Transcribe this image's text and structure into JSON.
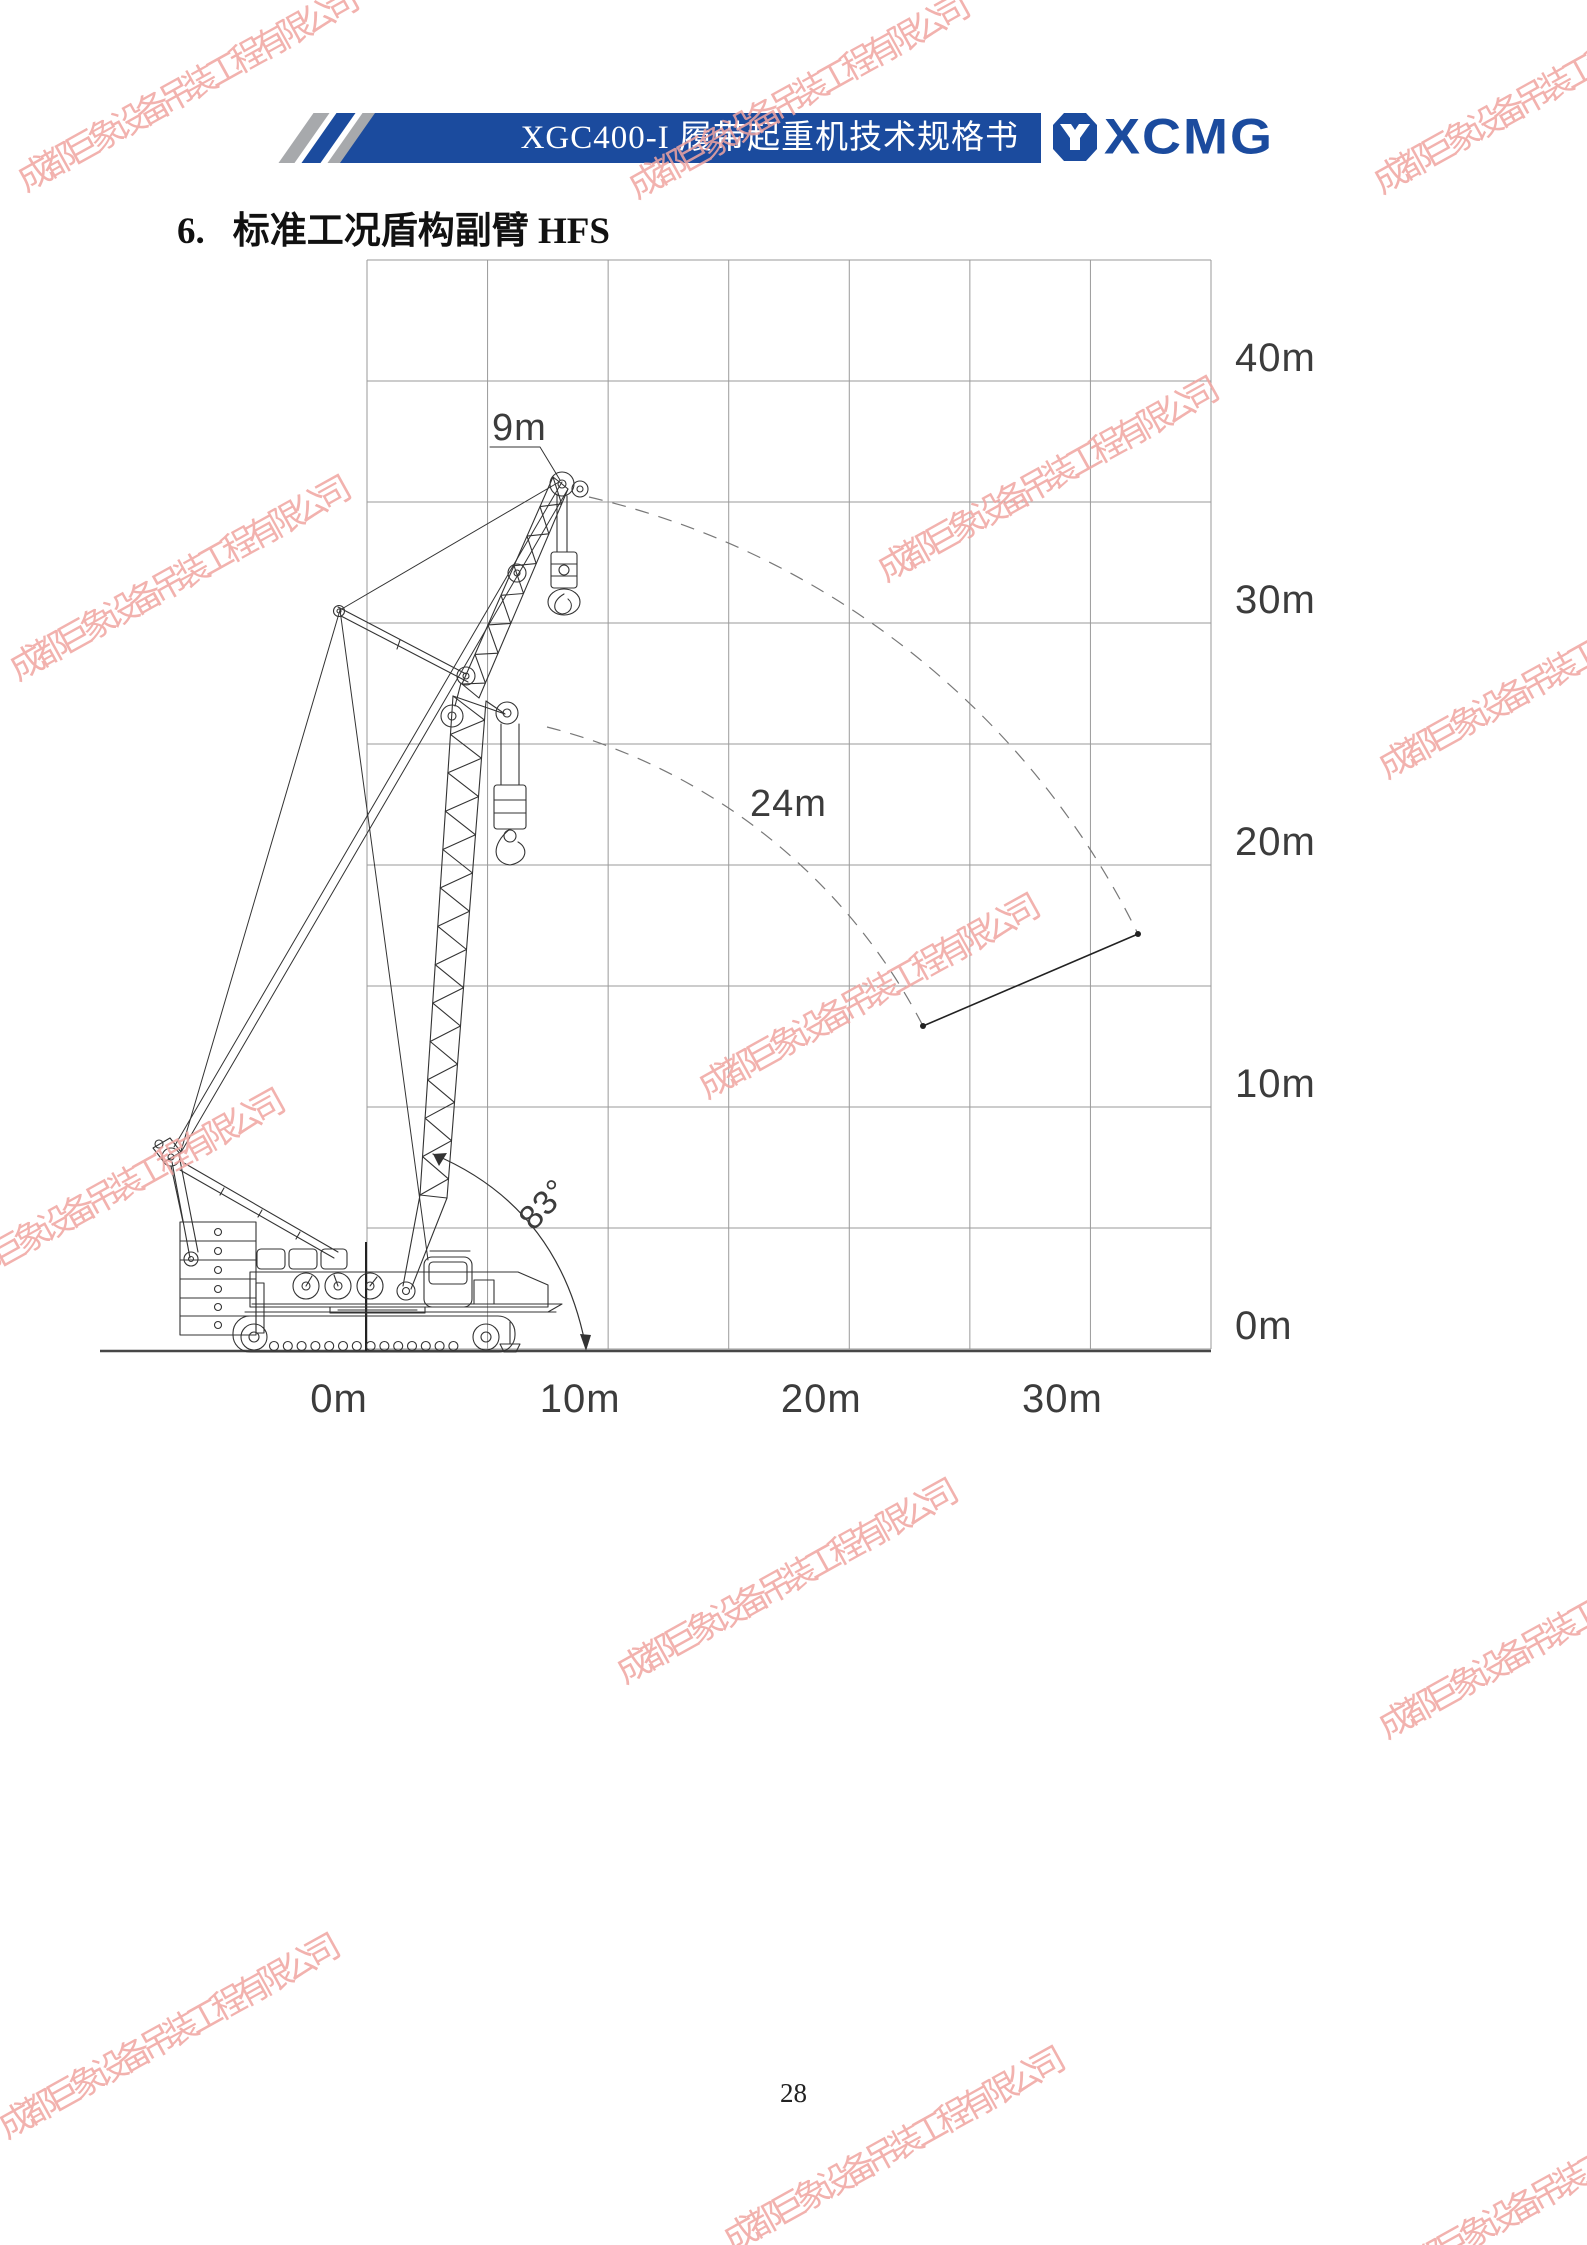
{
  "page": {
    "page_number": "28"
  },
  "header": {
    "banner_text": "XGC400-I 履带起重机技术规格书",
    "banner_color": "#1b4b9e",
    "stripe_gray": "#a7a9ac",
    "logo_text": "XCMG",
    "logo_icon": "xcmg-hexagon-icon"
  },
  "section": {
    "number": "6.",
    "title": "标准工况盾构副臂 HFS"
  },
  "watermark": {
    "text": "成都巨象设备吊装工程有限公司",
    "color": "#f0a5a1",
    "angle_deg": -29,
    "instances": [
      [
        184,
        88
      ],
      [
        795,
        95
      ],
      [
        1540,
        90
      ],
      [
        176,
        577
      ],
      [
        1044,
        478
      ],
      [
        1545,
        675
      ],
      [
        110,
        1190
      ],
      [
        865,
        995
      ],
      [
        1545,
        1635
      ],
      [
        783,
        1580
      ],
      [
        165,
        2035
      ],
      [
        890,
        2148
      ],
      [
        1555,
        2185
      ]
    ]
  },
  "chart_data": {
    "type": "diagram",
    "title": "标准工况盾构副臂 HFS 作业范围图",
    "x_axis_labels": [
      "0m",
      "10m",
      "20m",
      "30m"
    ],
    "y_axis_labels": [
      "40m",
      "30m",
      "20m",
      "10m",
      "0m"
    ],
    "axis_range": {
      "x_min_m": 0,
      "x_max_m": 35,
      "y_min_m": 0,
      "y_max_m": 45,
      "grid_step_m": 5
    },
    "annotations": {
      "jib_length": "9m",
      "boom_length": "24m",
      "boom_angle": "83°"
    },
    "notes": "Crawler crane side view with 24m main boom at 83°, 9m shield jib; dashed arcs show boom-head and jib-tip paths down to lowest position line."
  }
}
